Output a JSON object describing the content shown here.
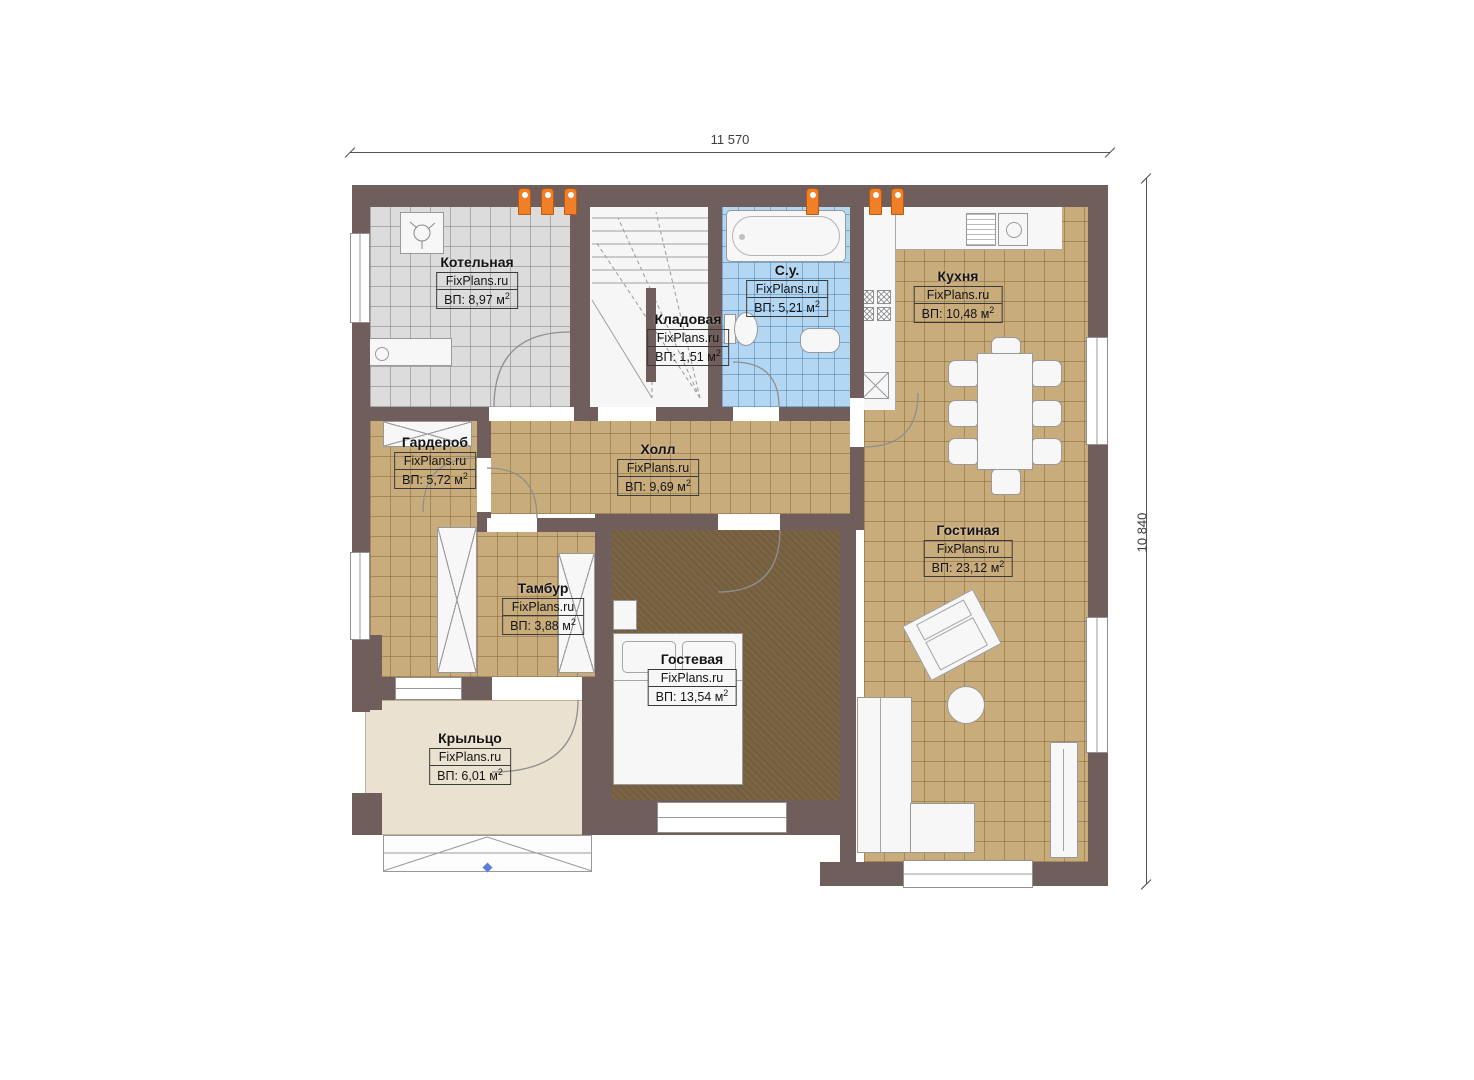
{
  "meta": {
    "brand_watermark": "FixPlans.ru",
    "area_superscript": "2",
    "plan_type": "floor-plan"
  },
  "dimensions": {
    "top_width": "11 570",
    "right_height": "10 840"
  },
  "colors": {
    "wall": "#6f5e5c",
    "tile_tan": "#c9ac7c",
    "tile_gray": "#dcdcdc",
    "tile_blue": "#b3d6f2",
    "carpet_brown": "#7b6444",
    "porch_beige": "#ebe1d0",
    "flue_orange": "#f07f28"
  },
  "rooms": {
    "kotelnaya": {
      "name": "Котельная",
      "brand": "FixPlans.ru",
      "area": "ВП: 8,97 м"
    },
    "kladovaya": {
      "name": "Кладовая",
      "brand": "FixPlans.ru",
      "area": "ВП: 1,51 м"
    },
    "su": {
      "name": "С.у.",
      "brand": "FixPlans.ru",
      "area": "ВП: 5,21 м"
    },
    "kuhnya": {
      "name": "Кухня",
      "brand": "FixPlans.ru",
      "area": "ВП: 10,48 м"
    },
    "garderob": {
      "name": "Гардероб",
      "brand": "FixPlans.ru",
      "area": "ВП: 5,72 м"
    },
    "holl": {
      "name": "Холл",
      "brand": "FixPlans.ru",
      "area": "ВП: 9,69 м"
    },
    "gostinaya": {
      "name": "Гостиная",
      "brand": "FixPlans.ru",
      "area": "ВП: 23,12 м"
    },
    "tambur": {
      "name": "Тамбур",
      "brand": "FixPlans.ru",
      "area": "ВП: 3,88 м"
    },
    "gostevaya": {
      "name": "Гостевая",
      "brand": "FixPlans.ru",
      "area": "ВП: 13,54 м"
    },
    "kryltso": {
      "name": "Крыльцо",
      "brand": "FixPlans.ru",
      "area": "ВП: 6,01 м"
    }
  }
}
